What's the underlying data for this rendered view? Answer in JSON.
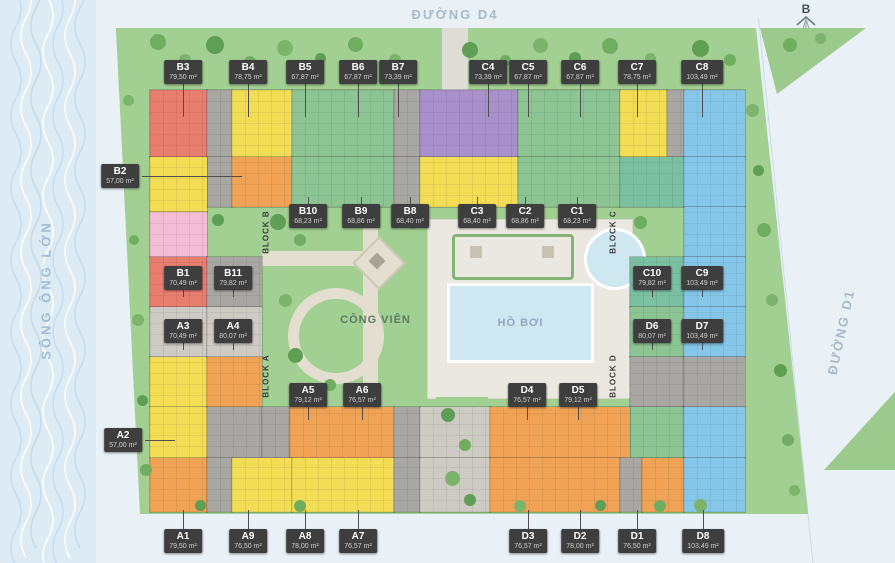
{
  "plan": {
    "streets": {
      "top": "ĐƯỜNG D4",
      "right": "ĐƯỜNG D1"
    },
    "river_name": "SÔNG ÔNG LỚN",
    "compass_label": "B",
    "park_label": "CÔNG VIÊN",
    "pool_label": "HỒ BƠI",
    "blocks": [
      {
        "label": "BLOCK B"
      },
      {
        "label": "BLOCK C"
      },
      {
        "label": "BLOCK A"
      },
      {
        "label": "BLOCK D"
      }
    ]
  },
  "colors": {
    "red": "#e87e70",
    "yellow": "#f2dd55",
    "green": "#8cc593",
    "teal": "#7cc0a2",
    "purple": "#a890ca",
    "blue": "#86c7e9",
    "orange": "#f0a355",
    "pink": "#f3bdd5",
    "core": "#a9a7a3",
    "lightGray": "#cecbc5",
    "badge": "#3e3e3e",
    "pool": "#cfe7f1",
    "lawn": "#a2cf92"
  },
  "units": [
    {
      "code": "B3",
      "area": "79,50 m²",
      "x": 183,
      "y": 72,
      "leader": "down",
      "len": 34
    },
    {
      "code": "B4",
      "area": "78,75 m²",
      "x": 248,
      "y": 72,
      "leader": "down",
      "len": 34
    },
    {
      "code": "B5",
      "area": "67,87 m²",
      "x": 305,
      "y": 72,
      "leader": "down",
      "len": 34
    },
    {
      "code": "B6",
      "area": "67,87 m²",
      "x": 358,
      "y": 72,
      "leader": "down",
      "len": 34
    },
    {
      "code": "B7",
      "area": "73,39 m²",
      "x": 398,
      "y": 72,
      "leader": "down",
      "len": 34
    },
    {
      "code": "C4",
      "area": "73,39 m²",
      "x": 488,
      "y": 72,
      "leader": "down",
      "len": 34
    },
    {
      "code": "C5",
      "area": "67,87 m²",
      "x": 528,
      "y": 72,
      "leader": "down",
      "len": 34
    },
    {
      "code": "C6",
      "area": "67,87 m²",
      "x": 580,
      "y": 72,
      "leader": "down",
      "len": 34
    },
    {
      "code": "C7",
      "area": "78,75 m²",
      "x": 637,
      "y": 72,
      "leader": "down",
      "len": 34
    },
    {
      "code": "C8",
      "area": "103,49 m²",
      "x": 702,
      "y": 72,
      "leader": "down",
      "len": 34
    },
    {
      "code": "B2",
      "area": "57,00 m²",
      "x": 120,
      "y": 176,
      "leader": "right",
      "len": 100
    },
    {
      "code": "B10",
      "area": "68,23 m²",
      "x": 308,
      "y": 216,
      "leader": "up",
      "len": 8
    },
    {
      "code": "B9",
      "area": "68,86 m²",
      "x": 361,
      "y": 216,
      "leader": "up",
      "len": 8
    },
    {
      "code": "B8",
      "area": "68,40 m²",
      "x": 410,
      "y": 216,
      "leader": "up",
      "len": 8
    },
    {
      "code": "C3",
      "area": "68,40 m²",
      "x": 477,
      "y": 216,
      "leader": "up",
      "len": 8
    },
    {
      "code": "C2",
      "area": "68,86 m²",
      "x": 525,
      "y": 216,
      "leader": "up",
      "len": 8
    },
    {
      "code": "C1",
      "area": "68,23 m²",
      "x": 577,
      "y": 216,
      "leader": "up",
      "len": 8
    },
    {
      "code": "B1",
      "area": "70,49 m²",
      "x": 183,
      "y": 278,
      "leader": "down",
      "len": 8
    },
    {
      "code": "B11",
      "area": "79,82 m²",
      "x": 233,
      "y": 278,
      "leader": "down",
      "len": 8
    },
    {
      "code": "C10",
      "area": "79,82 m²",
      "x": 652,
      "y": 278,
      "leader": "down",
      "len": 8
    },
    {
      "code": "C9",
      "area": "103,49 m²",
      "x": 702,
      "y": 278,
      "leader": "down",
      "len": 8
    },
    {
      "code": "A3",
      "area": "70,49 m²",
      "x": 183,
      "y": 331,
      "leader": "down",
      "len": 8
    },
    {
      "code": "A4",
      "area": "80,07 m²",
      "x": 233,
      "y": 331,
      "leader": "down",
      "len": 8
    },
    {
      "code": "D6",
      "area": "80,07 m²",
      "x": 652,
      "y": 331,
      "leader": "down",
      "len": 8
    },
    {
      "code": "D7",
      "area": "103,49 m²",
      "x": 702,
      "y": 331,
      "leader": "down",
      "len": 8
    },
    {
      "code": "A2",
      "area": "57,00 m²",
      "x": 123,
      "y": 440,
      "leader": "right",
      "len": 30
    },
    {
      "code": "A5",
      "area": "79,12 m²",
      "x": 308,
      "y": 395,
      "leader": "down",
      "len": 14
    },
    {
      "code": "A6",
      "area": "76,57 m²",
      "x": 362,
      "y": 395,
      "leader": "down",
      "len": 14
    },
    {
      "code": "D4",
      "area": "76,57 m²",
      "x": 527,
      "y": 395,
      "leader": "down",
      "len": 14
    },
    {
      "code": "D5",
      "area": "79,12 m²",
      "x": 578,
      "y": 395,
      "leader": "down",
      "len": 14
    },
    {
      "code": "A1",
      "area": "79,50 m²",
      "x": 183,
      "y": 541,
      "leader": "up",
      "len": 20
    },
    {
      "code": "A9",
      "area": "76,50 m²",
      "x": 248,
      "y": 541,
      "leader": "up",
      "len": 20
    },
    {
      "code": "A8",
      "area": "78,00 m²",
      "x": 305,
      "y": 541,
      "leader": "up",
      "len": 20
    },
    {
      "code": "A7",
      "area": "76,57 m²",
      "x": 358,
      "y": 541,
      "leader": "up",
      "len": 20
    },
    {
      "code": "D3",
      "area": "76,57 m²",
      "x": 528,
      "y": 541,
      "leader": "up",
      "len": 20
    },
    {
      "code": "D2",
      "area": "78,00 m²",
      "x": 580,
      "y": 541,
      "leader": "up",
      "len": 20
    },
    {
      "code": "D1",
      "area": "76,50 m²",
      "x": 637,
      "y": 541,
      "leader": "up",
      "len": 20
    },
    {
      "code": "D8",
      "area": "103,49 m²",
      "x": 703,
      "y": 541,
      "leader": "up",
      "len": 20
    }
  ]
}
